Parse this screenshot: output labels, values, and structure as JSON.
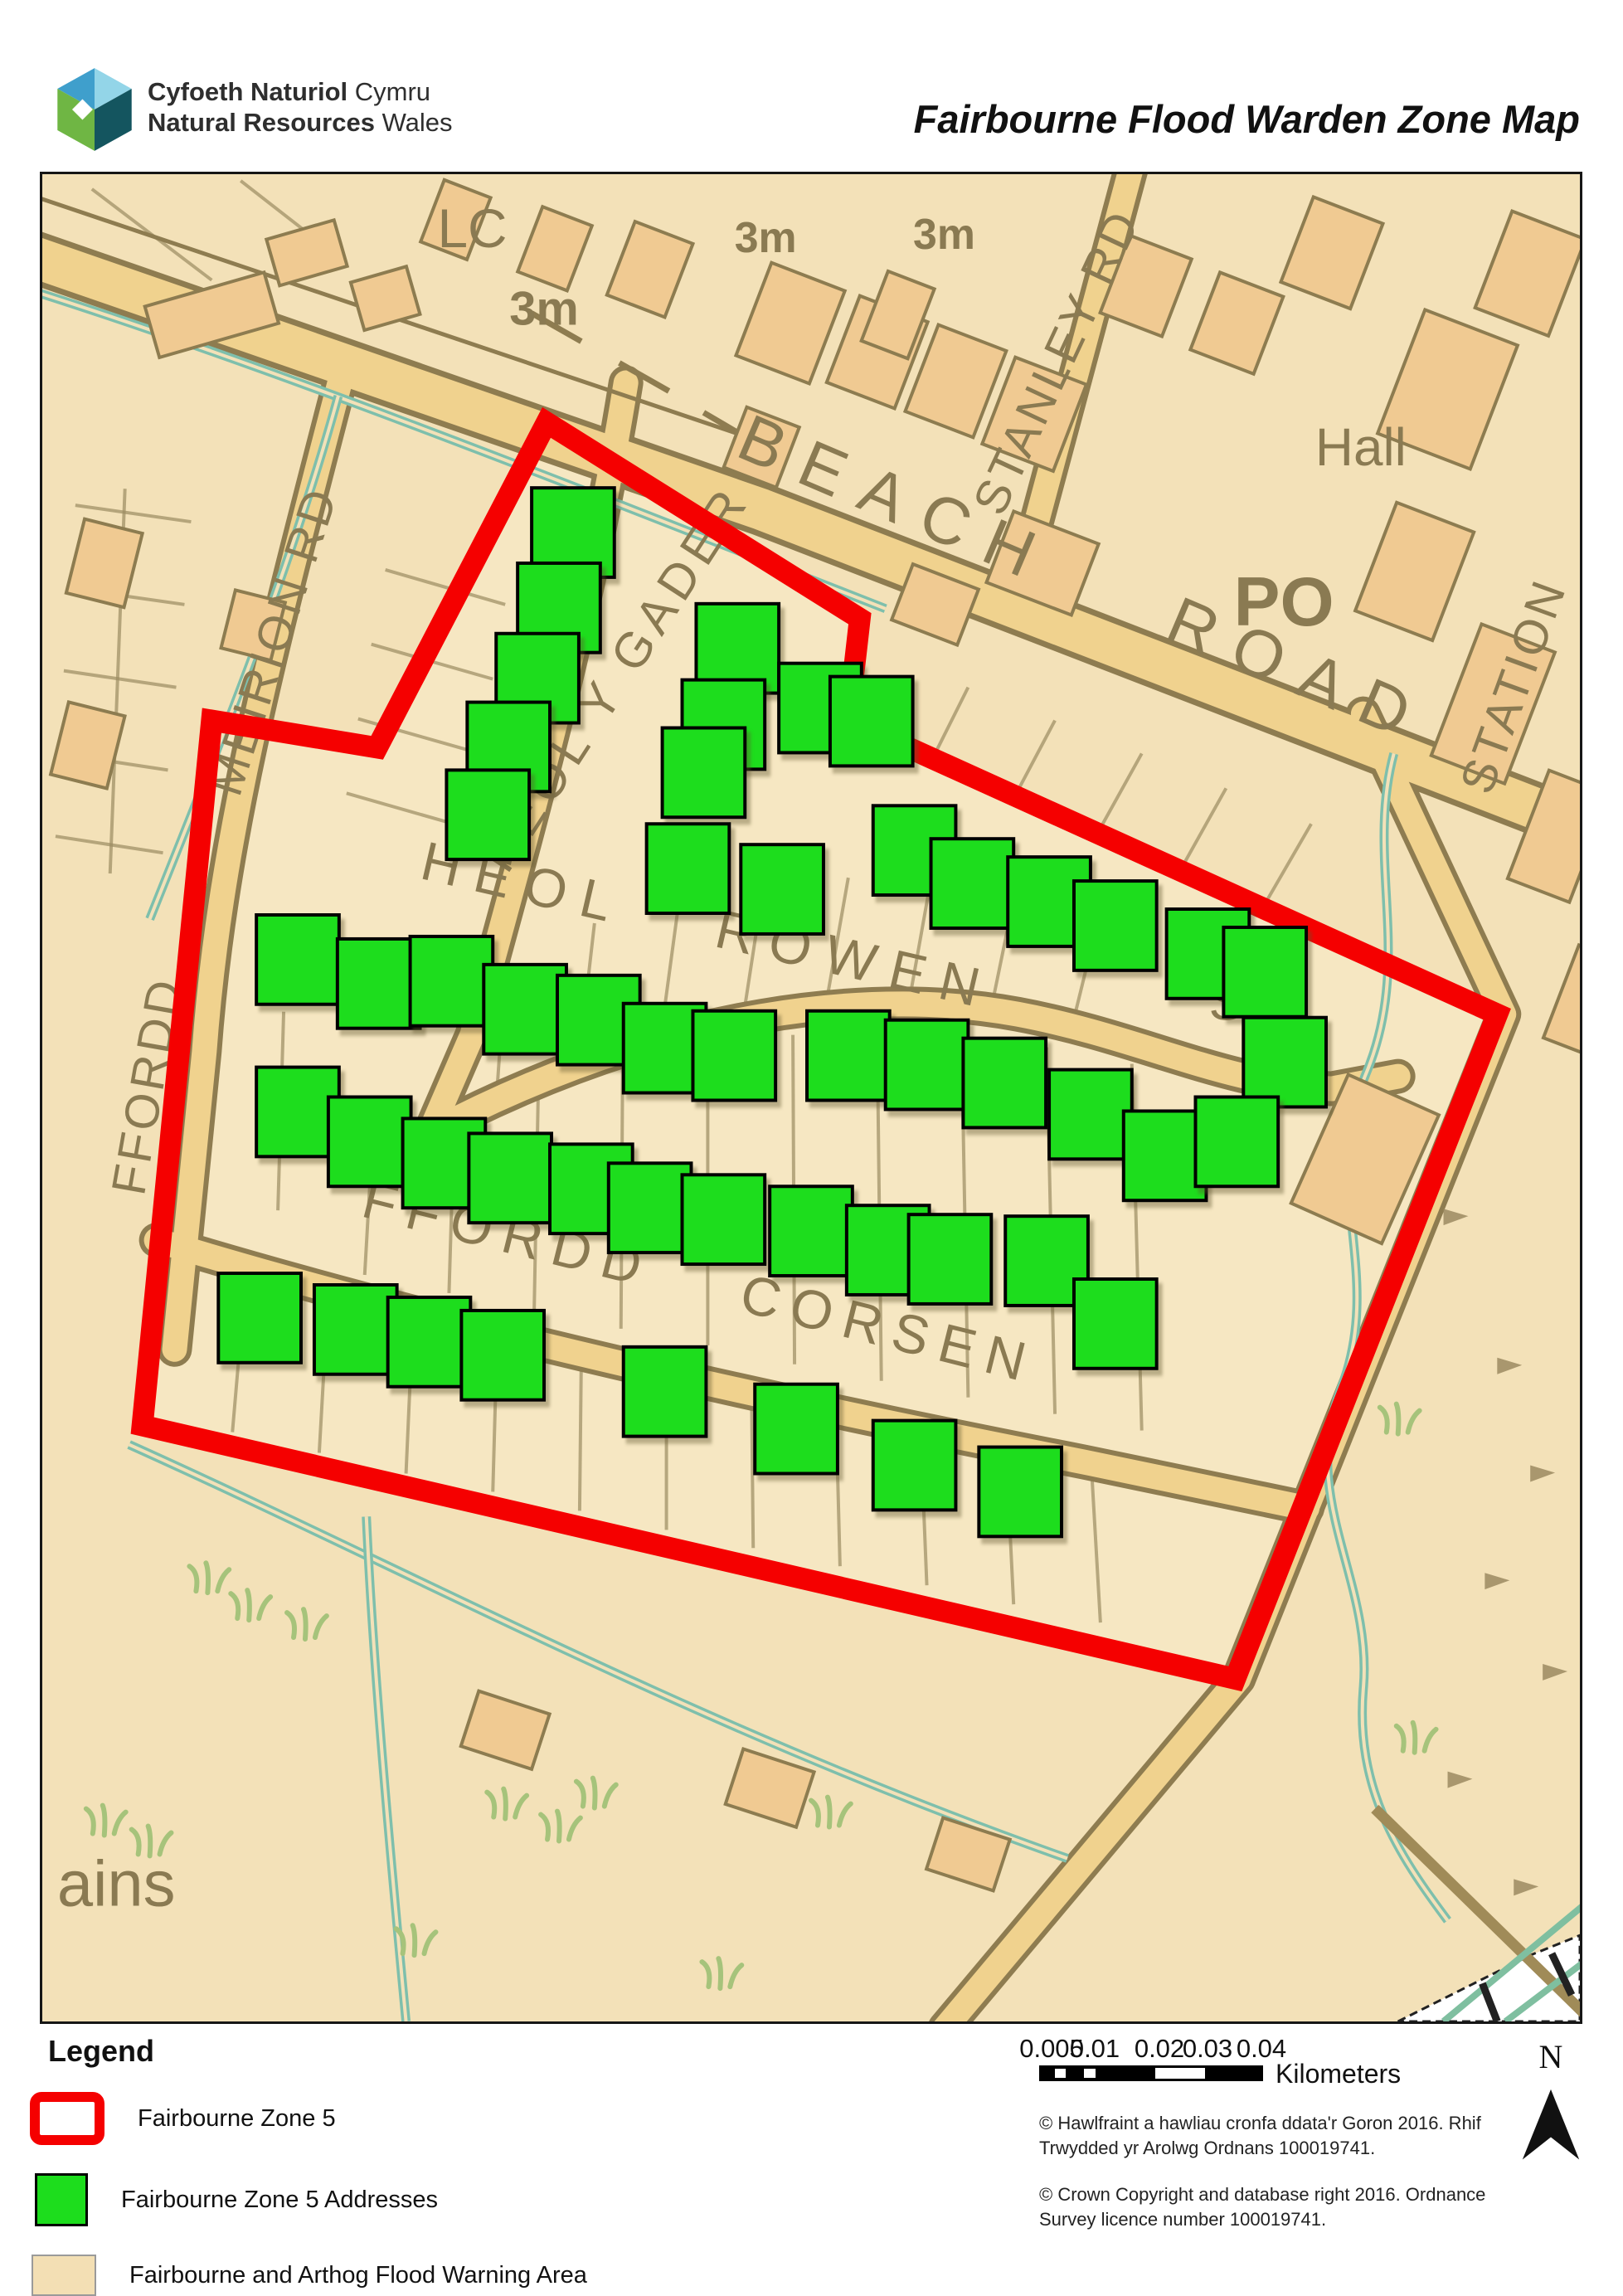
{
  "header": {
    "org_cy_bold": "Cyfoeth Naturiol",
    "org_cy_rest": " Cymru",
    "org_en_bold": "Natural Resources",
    "org_en_rest": " Wales",
    "title": "Fairbourne Flood Warden Zone Map"
  },
  "map": {
    "colors": {
      "zone_red": "#F50000",
      "address_green": "#1DDD1D",
      "flood_tan": "#F3E1B8",
      "road_fill": "#F0D28E",
      "road_casing": "#8E7C50",
      "stream_teal": "#7EBFAC"
    },
    "labels": {
      "lc": "LC",
      "h3m_a": "3m",
      "h3m_b": "3m",
      "h3m_c": "3m",
      "beach_road": "BEACH ROAD",
      "stanley_rd": "STANLEY RD",
      "station": "STATION",
      "hall": "Hall",
      "po": "PO",
      "sta": "Sta.",
      "heol_y_gader": "HEOL Y GADER",
      "heol_rowen": "HEOL ROWEN",
      "ffordd_corsen": "FFORDD CORSEN",
      "meirion_rd": "MEIRION RD",
      "ffordd": "FFORDD",
      "ains": "ains"
    },
    "zone_polygon": "610,300 989,537 975,660 1760,1015 1443,1818 121,1512 205,660 405,693",
    "addresses": [
      [
        642,
        433
      ],
      [
        625,
        524
      ],
      [
        599,
        609
      ],
      [
        564,
        692
      ],
      [
        539,
        774
      ],
      [
        841,
        573
      ],
      [
        824,
        665
      ],
      [
        800,
        723
      ],
      [
        941,
        645
      ],
      [
        1003,
        661
      ],
      [
        781,
        839
      ],
      [
        895,
        864
      ],
      [
        1055,
        817
      ],
      [
        1125,
        857
      ],
      [
        1218,
        879
      ],
      [
        1298,
        908
      ],
      [
        1410,
        942
      ],
      [
        1479,
        964
      ],
      [
        1503,
        1073
      ],
      [
        309,
        949
      ],
      [
        407,
        978
      ],
      [
        495,
        975
      ],
      [
        584,
        1009
      ],
      [
        673,
        1022
      ],
      [
        753,
        1056
      ],
      [
        837,
        1065
      ],
      [
        975,
        1065
      ],
      [
        1070,
        1076
      ],
      [
        1164,
        1098
      ],
      [
        1268,
        1136
      ],
      [
        1358,
        1186
      ],
      [
        1445,
        1169
      ],
      [
        309,
        1133
      ],
      [
        396,
        1169
      ],
      [
        486,
        1195
      ],
      [
        566,
        1213
      ],
      [
        664,
        1226
      ],
      [
        735,
        1249
      ],
      [
        824,
        1263
      ],
      [
        930,
        1277
      ],
      [
        1023,
        1300
      ],
      [
        1098,
        1311
      ],
      [
        1215,
        1313
      ],
      [
        1298,
        1389
      ],
      [
        263,
        1382
      ],
      [
        379,
        1396
      ],
      [
        468,
        1411
      ],
      [
        557,
        1427
      ],
      [
        753,
        1471
      ],
      [
        912,
        1516
      ],
      [
        1055,
        1560
      ],
      [
        1183,
        1592
      ]
    ],
    "buildings": [
      [
        735,
        115,
        75,
        95,
        21
      ],
      [
        905,
        180,
        95,
        120,
        21
      ],
      [
        1010,
        215,
        88,
        112,
        21
      ],
      [
        1105,
        250,
        88,
        112,
        21
      ],
      [
        1200,
        290,
        92,
        112,
        21
      ],
      [
        1335,
        135,
        80,
        100,
        21
      ],
      [
        1445,
        180,
        82,
        100,
        21
      ],
      [
        1560,
        95,
        90,
        110,
        21
      ],
      [
        1700,
        260,
        120,
        160,
        21
      ],
      [
        1800,
        120,
        95,
        125,
        21
      ],
      [
        1660,
        480,
        100,
        140,
        21
      ],
      [
        1755,
        640,
        95,
        170,
        21
      ],
      [
        1835,
        800,
        80,
        140,
        21
      ],
      [
        1210,
        470,
        110,
        92,
        21
      ],
      [
        1080,
        520,
        85,
        72,
        21
      ],
      [
        870,
        330,
        68,
        78,
        21
      ],
      [
        205,
        170,
        150,
        64,
        -16
      ],
      [
        320,
        95,
        85,
        58,
        -16
      ],
      [
        75,
        470,
        72,
        92,
        14
      ],
      [
        55,
        690,
        70,
        90,
        14
      ],
      [
        255,
        545,
        62,
        72,
        14
      ],
      [
        1600,
        1190,
        120,
        170,
        24
      ],
      [
        1035,
        170,
        60,
        90,
        21
      ],
      [
        620,
        90,
        64,
        84,
        21
      ],
      [
        500,
        55,
        60,
        80,
        21
      ],
      [
        415,
        150,
        70,
        60,
        -16
      ],
      [
        1870,
        1000,
        70,
        120,
        21
      ],
      [
        560,
        1880,
        90,
        70,
        18
      ],
      [
        880,
        1950,
        90,
        70,
        18
      ],
      [
        1120,
        2030,
        85,
        65,
        18
      ]
    ],
    "grass": [
      [
        250,
        1745
      ],
      [
        318,
        1768
      ],
      [
        200,
        1712
      ],
      [
        75,
        2005
      ],
      [
        130,
        2030
      ],
      [
        560,
        1985
      ],
      [
        625,
        2012
      ],
      [
        668,
        1972
      ],
      [
        952,
        1995
      ],
      [
        1640,
        1520
      ],
      [
        1660,
        1905
      ],
      [
        450,
        2150
      ],
      [
        820,
        2190
      ]
    ],
    "scree": [
      [
        1695,
        1250
      ],
      [
        1760,
        1430
      ],
      [
        1800,
        1560
      ],
      [
        1745,
        1690
      ],
      [
        1815,
        1800
      ],
      [
        1700,
        1930
      ],
      [
        1780,
        2060
      ]
    ]
  },
  "legend": {
    "title": "Legend",
    "zone5": "Fairbourne Zone 5",
    "addresses": "Fairbourne Zone 5 Addresses",
    "flood": "Fairbourne and Arthog Flood Warning Area"
  },
  "scalebar": {
    "ticks": [
      "0.005",
      "0.01",
      "0.02",
      "0.03",
      "0.04"
    ],
    "unit": "Kilometers"
  },
  "credits": {
    "welsh": "© Hawlfraint a hawliau cronfa ddata'r Goron 2016. Rhif Trwydded yr Arolwg Ordnans 100019741.",
    "english": "© Crown Copyright and database right 2016. Ordnance Survey licence number 100019741."
  },
  "north": {
    "label": "N"
  }
}
